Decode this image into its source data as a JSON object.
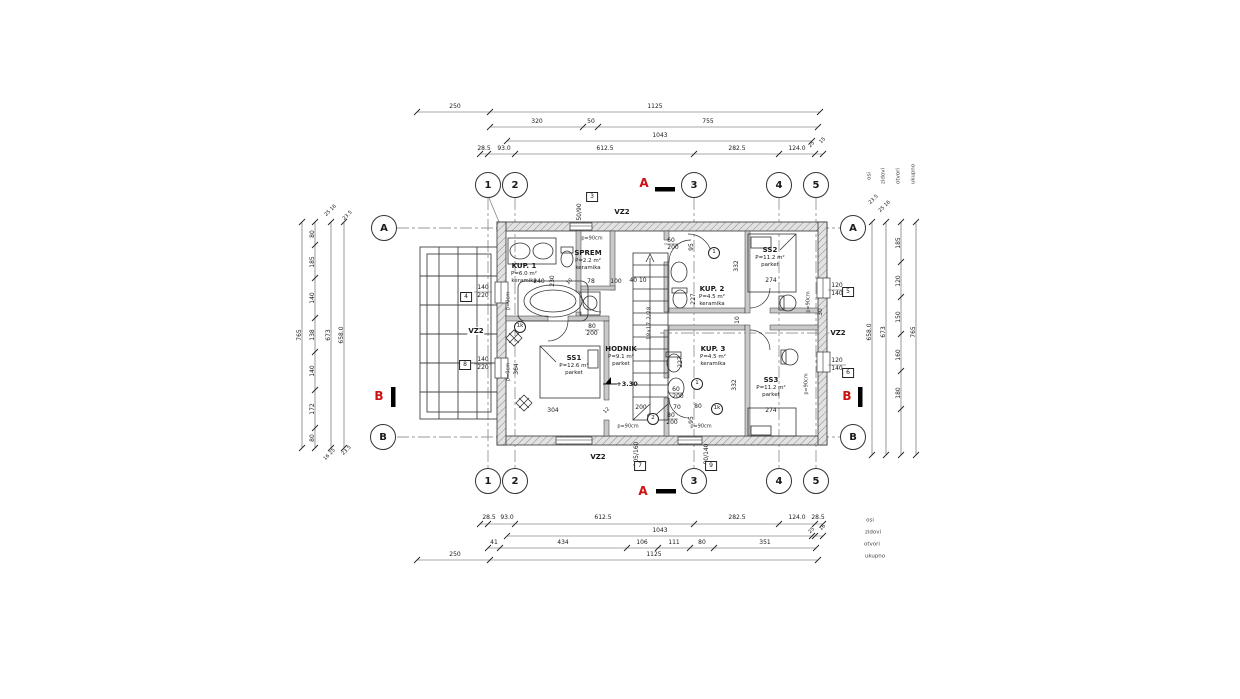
{
  "drawing": {
    "type": "architectural-floor-plan",
    "wall_label": "VZ2",
    "level_mark": "+3.30",
    "stair_text": "18x17.2/28",
    "accent_red": "#c11111",
    "line_color": "#333333"
  },
  "grid": {
    "cols": [
      "1",
      "2",
      "3",
      "4",
      "5"
    ],
    "rows": [
      "A",
      "B"
    ]
  },
  "sections": {
    "a": "A",
    "b": "B"
  },
  "rooms": [
    {
      "name": "KUP. 1",
      "area": "P=6.0 m²",
      "floor": "keramika"
    },
    {
      "name": "SPREM",
      "area": "P=2.2 m²",
      "floor": "keramika"
    },
    {
      "name": "KUP. 2",
      "area": "P=4.5 m²",
      "floor": "keramika"
    },
    {
      "name": "KUP. 3",
      "area": "P=4.5 m²",
      "floor": "keramika"
    },
    {
      "name": "SS1",
      "area": "P=12.6 m²",
      "floor": "parket"
    },
    {
      "name": "SS2",
      "area": "P=11.2 m²",
      "floor": "parket"
    },
    {
      "name": "SS3",
      "area": "P=11.2 m²",
      "floor": "parket"
    },
    {
      "name": "HODNIK",
      "area": "P=9.1 m²",
      "floor": "parket"
    }
  ],
  "dimension_chains": {
    "top": [
      [
        "250",
        "1125"
      ],
      [
        "320",
        "50",
        "755"
      ],
      [
        "1043"
      ],
      [
        "28.5",
        "93.0",
        "612.5",
        "282.5",
        "124.0",
        "25",
        "15"
      ]
    ],
    "bottom_osi": [
      "28.5",
      "93.0",
      "612.5",
      "282.5",
      "124.0",
      "28.5"
    ],
    "bottom_zidovi": [
      "25",
      "16",
      "1043"
    ],
    "bottom_otvori": [
      "41",
      "434",
      "106",
      "111",
      "80",
      "351"
    ],
    "bottom_ukupno": [
      "250",
      "1125"
    ],
    "row_labels": [
      "osi",
      "zidovi",
      "otvori",
      "ukupno"
    ],
    "left_vertical": [
      "765",
      "80",
      "185",
      "140",
      "138",
      "140",
      "172",
      "80",
      "673",
      "658.0"
    ],
    "right_vertical": [
      "658.0",
      "673",
      "185",
      "120",
      "150",
      "160",
      "180",
      "765"
    ]
  },
  "annotations": [
    {
      "t": "250",
      "x": 455,
      "y": 107
    },
    {
      "t": "1125",
      "x": 655,
      "y": 107
    },
    {
      "t": "320",
      "x": 537,
      "y": 122
    },
    {
      "t": "50",
      "x": 591,
      "y": 122
    },
    {
      "t": "755",
      "x": 708,
      "y": 122
    },
    {
      "t": "1043",
      "x": 660,
      "y": 136
    },
    {
      "t": "28.5",
      "x": 484,
      "y": 149
    },
    {
      "t": "93.0",
      "x": 504,
      "y": 149
    },
    {
      "t": "612.5",
      "x": 605,
      "y": 149
    },
    {
      "t": "282.5",
      "x": 737,
      "y": 149
    },
    {
      "t": "124.0",
      "x": 797,
      "y": 149
    },
    {
      "t": "25",
      "x": 812,
      "y": 145,
      "c": "d45"
    },
    {
      "t": "15",
      "x": 823,
      "y": 141,
      "c": "d45"
    },
    {
      "t": "28.5",
      "x": 489,
      "y": 518
    },
    {
      "t": "93.0",
      "x": 507,
      "y": 518
    },
    {
      "t": "612.5",
      "x": 603,
      "y": 518
    },
    {
      "t": "282.5",
      "x": 737,
      "y": 518
    },
    {
      "t": "124.0",
      "x": 797,
      "y": 518
    },
    {
      "t": "28.5",
      "x": 818,
      "y": 518
    },
    {
      "t": "osi",
      "x": 870,
      "y": 521,
      "c": "lbl"
    },
    {
      "t": "25",
      "x": 812,
      "y": 531,
      "c": "d45"
    },
    {
      "t": "16",
      "x": 823,
      "y": 528,
      "c": "d45"
    },
    {
      "t": "1043",
      "x": 660,
      "y": 531
    },
    {
      "t": "zidovi",
      "x": 873,
      "y": 533,
      "c": "lbl"
    },
    {
      "t": "41",
      "x": 494,
      "y": 543
    },
    {
      "t": "434",
      "x": 563,
      "y": 543
    },
    {
      "t": "106",
      "x": 642,
      "y": 543
    },
    {
      "t": "111",
      "x": 674,
      "y": 543
    },
    {
      "t": "80",
      "x": 702,
      "y": 543
    },
    {
      "t": "351",
      "x": 765,
      "y": 543
    },
    {
      "t": "otvori",
      "x": 872,
      "y": 545,
      "c": "lbl"
    },
    {
      "t": "250",
      "x": 455,
      "y": 555
    },
    {
      "t": "1125",
      "x": 654,
      "y": 555
    },
    {
      "t": "ukupno",
      "x": 875,
      "y": 557,
      "c": "lbl"
    },
    {
      "t": "765",
      "x": 300,
      "y": 335,
      "c": "dv"
    },
    {
      "t": "80",
      "x": 313,
      "y": 234,
      "c": "dv"
    },
    {
      "t": "185",
      "x": 313,
      "y": 262,
      "c": "dv"
    },
    {
      "t": "140",
      "x": 313,
      "y": 298,
      "c": "dv"
    },
    {
      "t": "138",
      "x": 313,
      "y": 335,
      "c": "dv"
    },
    {
      "t": "140",
      "x": 313,
      "y": 371,
      "c": "dv"
    },
    {
      "t": "172",
      "x": 313,
      "y": 409,
      "c": "dv"
    },
    {
      "t": "80",
      "x": 313,
      "y": 438,
      "c": "dv"
    },
    {
      "t": "673",
      "x": 329,
      "y": 335,
      "c": "dv"
    },
    {
      "t": "658.0",
      "x": 342,
      "y": 335,
      "c": "dv"
    },
    {
      "t": "25 16",
      "x": 331,
      "y": 211,
      "c": "d45"
    },
    {
      "t": "23.5",
      "x": 348,
      "y": 216,
      "c": "d45"
    },
    {
      "t": "16 25",
      "x": 330,
      "y": 455,
      "c": "d45"
    },
    {
      "t": "23.5",
      "x": 347,
      "y": 451,
      "c": "d45"
    },
    {
      "t": "658.0",
      "x": 870,
      "y": 332,
      "c": "dv"
    },
    {
      "t": "673",
      "x": 884,
      "y": 332,
      "c": "dv"
    },
    {
      "t": "185",
      "x": 899,
      "y": 243,
      "c": "dv"
    },
    {
      "t": "120",
      "x": 899,
      "y": 281,
      "c": "dv"
    },
    {
      "t": "150",
      "x": 899,
      "y": 317,
      "c": "dv"
    },
    {
      "t": "160",
      "x": 899,
      "y": 355,
      "c": "dv"
    },
    {
      "t": "180",
      "x": 899,
      "y": 393,
      "c": "dv"
    },
    {
      "t": "765",
      "x": 914,
      "y": 332,
      "c": "dv"
    },
    {
      "t": "23.5",
      "x": 874,
      "y": 200,
      "c": "d45"
    },
    {
      "t": "25 16",
      "x": 885,
      "y": 207,
      "c": "d45"
    },
    {
      "t": "osi",
      "x": 870,
      "y": 176,
      "c": "dvl"
    },
    {
      "t": "zidovi",
      "x": 884,
      "y": 176,
      "c": "dvl"
    },
    {
      "t": "otvori",
      "x": 899,
      "y": 176,
      "c": "dvl"
    },
    {
      "t": "ukupno",
      "x": 914,
      "y": 174,
      "c": "dvl"
    },
    {
      "t": "140",
      "x": 483,
      "y": 288
    },
    {
      "t": "220",
      "x": 483,
      "y": 296
    },
    {
      "t": "140",
      "x": 483,
      "y": 360
    },
    {
      "t": "220",
      "x": 483,
      "y": 368
    },
    {
      "t": "120",
      "x": 837,
      "y": 286
    },
    {
      "t": "140",
      "x": 837,
      "y": 294
    },
    {
      "t": "120",
      "x": 837,
      "y": 361
    },
    {
      "t": "140",
      "x": 837,
      "y": 369
    },
    {
      "t": "50/90",
      "x": 580,
      "y": 212,
      "c": "dv"
    },
    {
      "t": "105/160",
      "x": 637,
      "y": 454,
      "c": "dv"
    },
    {
      "t": "80/140",
      "x": 707,
      "y": 454,
      "c": "dv"
    },
    {
      "t": "80",
      "x": 592,
      "y": 327
    },
    {
      "t": "200",
      "x": 592,
      "y": 334
    },
    {
      "t": "60",
      "x": 671,
      "y": 241
    },
    {
      "t": "200",
      "x": 673,
      "y": 248
    },
    {
      "t": "60",
      "x": 676,
      "y": 390
    },
    {
      "t": "200",
      "x": 678,
      "y": 397
    },
    {
      "t": "80",
      "x": 671,
      "y": 416
    },
    {
      "t": "200",
      "x": 672,
      "y": 423
    },
    {
      "t": "p=90cm",
      "x": 592,
      "y": 239,
      "c": "ps"
    },
    {
      "t": "p=90cm",
      "x": 628,
      "y": 427,
      "c": "ps"
    },
    {
      "t": "p=90cm",
      "x": 701,
      "y": 427,
      "c": "ps"
    },
    {
      "t": "p=90cm",
      "x": 809,
      "y": 302,
      "c": "psv"
    },
    {
      "t": "p=90cm",
      "x": 807,
      "y": 384,
      "c": "psv"
    },
    {
      "t": "p=0cm",
      "x": 509,
      "y": 301,
      "c": "psv"
    },
    {
      "t": "p=0cm",
      "x": 509,
      "y": 372,
      "c": "psv"
    },
    {
      "t": "3",
      "x": 592,
      "y": 197,
      "c": "bx"
    },
    {
      "t": "7",
      "x": 640,
      "y": 466,
      "c": "bx"
    },
    {
      "t": "9",
      "x": 711,
      "y": 466,
      "c": "bx"
    },
    {
      "t": "5",
      "x": 848,
      "y": 292,
      "c": "bx"
    },
    {
      "t": "6",
      "x": 848,
      "y": 373,
      "c": "bx"
    },
    {
      "t": "4",
      "x": 466,
      "y": 297,
      "c": "bx"
    },
    {
      "t": "8",
      "x": 465,
      "y": 365,
      "c": "bx"
    },
    {
      "t": "1k",
      "x": 520,
      "y": 327,
      "c": "ci"
    },
    {
      "t": "1",
      "x": 714,
      "y": 253,
      "c": "ci"
    },
    {
      "t": "1",
      "x": 697,
      "y": 384,
      "c": "ci"
    },
    {
      "t": "2",
      "x": 653,
      "y": 419,
      "c": "ci"
    },
    {
      "t": "1k",
      "x": 717,
      "y": 409,
      "c": "ci"
    },
    {
      "t": "240",
      "x": 539,
      "y": 282
    },
    {
      "t": "230",
      "x": 553,
      "y": 281,
      "c": "dv"
    },
    {
      "t": "10",
      "x": 570,
      "y": 282,
      "c": "d45"
    },
    {
      "t": "78",
      "x": 591,
      "y": 282
    },
    {
      "t": "100",
      "x": 616,
      "y": 282
    },
    {
      "t": "40 10",
      "x": 638,
      "y": 281
    },
    {
      "t": "227",
      "x": 694,
      "y": 299,
      "c": "dv"
    },
    {
      "t": "227",
      "x": 681,
      "y": 362,
      "c": "dv"
    },
    {
      "t": "332",
      "x": 737,
      "y": 266,
      "c": "dv"
    },
    {
      "t": "332",
      "x": 735,
      "y": 385,
      "c": "dv"
    },
    {
      "t": "10",
      "x": 738,
      "y": 320,
      "c": "dv"
    },
    {
      "t": "30",
      "x": 821,
      "y": 312,
      "c": "dv"
    },
    {
      "t": "95",
      "x": 692,
      "y": 247,
      "c": "dv"
    },
    {
      "t": "95",
      "x": 692,
      "y": 420,
      "c": "dv"
    },
    {
      "t": "364",
      "x": 517,
      "y": 369,
      "c": "dv"
    },
    {
      "t": "304",
      "x": 553,
      "y": 411
    },
    {
      "t": "12",
      "x": 607,
      "y": 411,
      "c": "d45"
    },
    {
      "t": "200",
      "x": 641,
      "y": 408
    },
    {
      "t": "70",
      "x": 677,
      "y": 408
    },
    {
      "t": "80",
      "x": 698,
      "y": 407
    },
    {
      "t": "274",
      "x": 771,
      "y": 281
    },
    {
      "t": "274",
      "x": 771,
      "y": 411
    },
    {
      "t": "+3.30",
      "x": 627,
      "y": 384,
      "c": "lvl"
    },
    {
      "t": "18x17.2/28",
      "x": 650,
      "y": 323,
      "c": "st"
    }
  ]
}
